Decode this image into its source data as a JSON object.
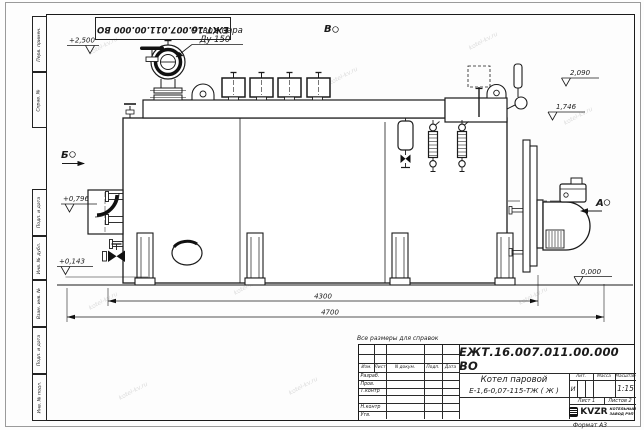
{
  "sheet": {
    "format_note": "Формат А3",
    "reference_note": "Все размеры для справок",
    "doc_number_stamp": "ЕЖТ.16.007.011.00.000  ВО",
    "margin_stamps": {
      "top": [
        "Перв. примен.",
        "Справ. №"
      ],
      "bottom": [
        "Подп. и дата",
        "Инв. № дубл.",
        "Взам. инв. №",
        "Подп. и дата",
        "Инв. № подл."
      ]
    }
  },
  "title_block": {
    "doc_number": "ЕЖТ.16.007.011.00.000  ВО",
    "product_name": "Котел паровой",
    "product_model": "Е-1,6-0,07-115-ТЖ ( Ж )",
    "header_cells": [
      "Изм.",
      "Лист",
      "N докум.",
      "Подп.",
      "Дата"
    ],
    "sign_rows": [
      "Разраб.",
      "Пров.",
      "Т.контр",
      "Н.контр",
      "Утв."
    ],
    "lit_label": "Лит.",
    "lit_value": "И",
    "mass_label": "Масса",
    "scale_label": "Масштаб",
    "scale_value": "1:15",
    "sheet_cell": "Лист 1",
    "sheets_cell": "Листов 2",
    "logo_text": "KVZR",
    "company_line1": "КОТЕЛЬНЫЙ",
    "company_line2": "ЗАВОД РЭП"
  },
  "drawing": {
    "callout_line1": "Отвод пара",
    "callout_line2": "Ду 150",
    "view_b_top": "В",
    "view_b_left": "Б",
    "view_a_right": "А",
    "levels": [
      "+2,500",
      "2,090",
      "1,746",
      "+0,796",
      "+0,143",
      "0,000"
    ],
    "dim_inner": "4300",
    "dim_outer": "4700"
  },
  "watermark": "kotel-kv.ru"
}
